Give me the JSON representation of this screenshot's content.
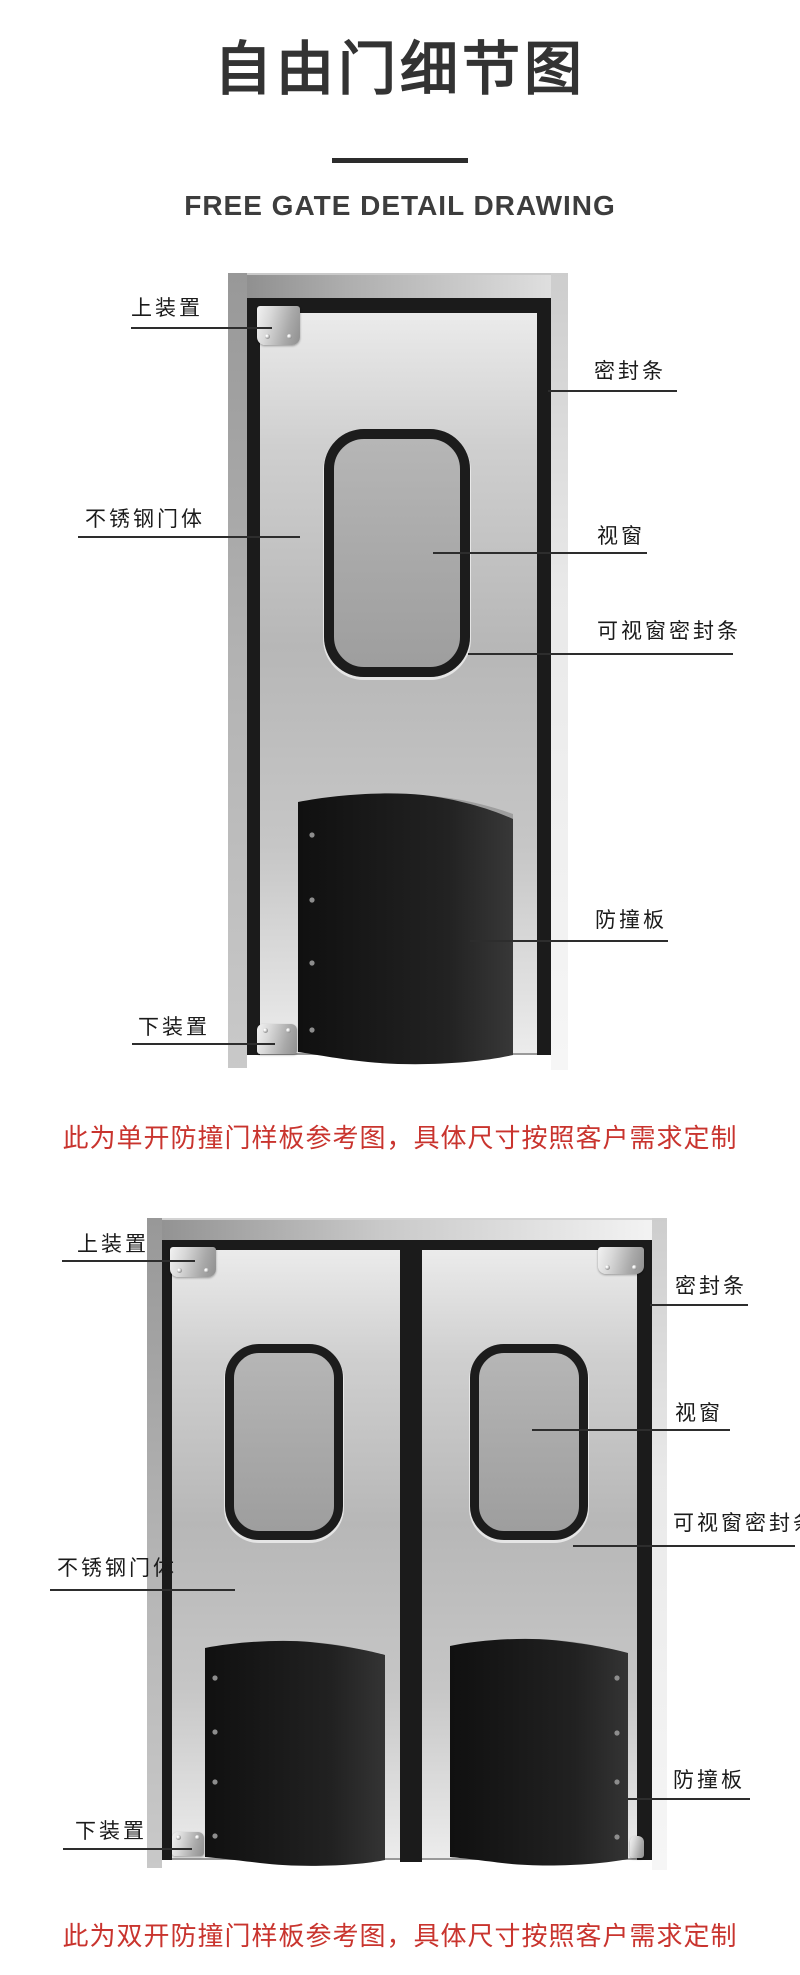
{
  "page": {
    "title": "自由门细节图",
    "subtitle": "FREE GATE DETAIL DRAWING"
  },
  "colors": {
    "accent_red": "#c9342e",
    "part_black": "#1b1b1b",
    "leader_line": "#2d2d2d",
    "title_text": "#333333"
  },
  "diagram_single": {
    "caption": "此为单开防撞门样板参考图，具体尺寸按照客户需求定制",
    "labels": {
      "top_device": "上装置",
      "door_seal": "密封条",
      "door_body": "不锈钢门体",
      "window": "视窗",
      "window_seal": "可视窗密封条",
      "bumper": "防撞板",
      "bottom_device": "下装置"
    }
  },
  "diagram_double": {
    "caption": "此为双开防撞门样板参考图，具体尺寸按照客户需求定制",
    "labels": {
      "top_device": "上装置",
      "door_seal": "密封条",
      "door_body": "不锈钢门体",
      "window": "视窗",
      "window_seal": "可视窗密封条",
      "bumper": "防撞板",
      "bottom_device": "下装置"
    }
  }
}
